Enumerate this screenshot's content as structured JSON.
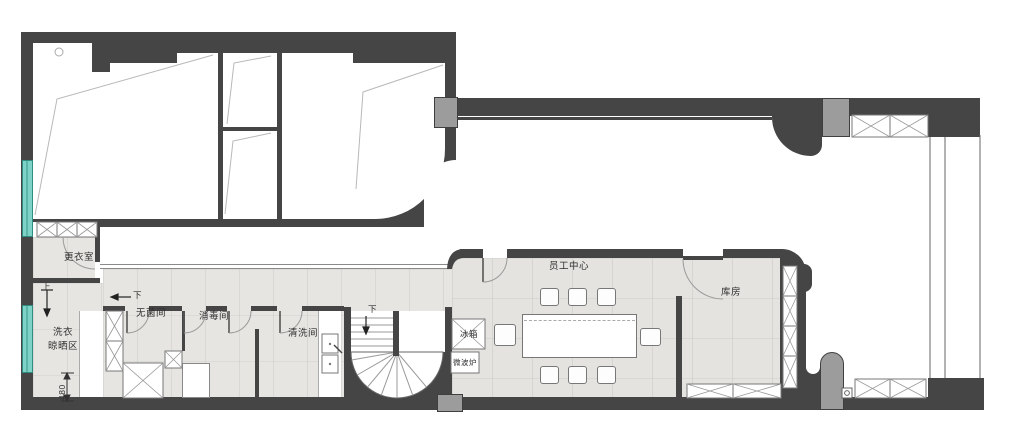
{
  "title": "floor-plan",
  "labels": {
    "changing_room": "更衣室",
    "laundry_line1": "洗衣",
    "laundry_line2": "晾晒区",
    "up": "上",
    "down_corridor": "下",
    "sterile_room": "无菌间",
    "disinfection_room": "消毒间",
    "washing_room": "清洗间",
    "down_stair": "下",
    "fridge": "冰箱",
    "microwave": "微波炉",
    "staff_center": "员工中心",
    "storage_room": "库房",
    "dim_480": "480"
  },
  "colors": {
    "wall": "#454545",
    "column_gray": "#9c9c9c",
    "window_teal": "#7fd3c6",
    "floor": "#e4e3e0"
  }
}
